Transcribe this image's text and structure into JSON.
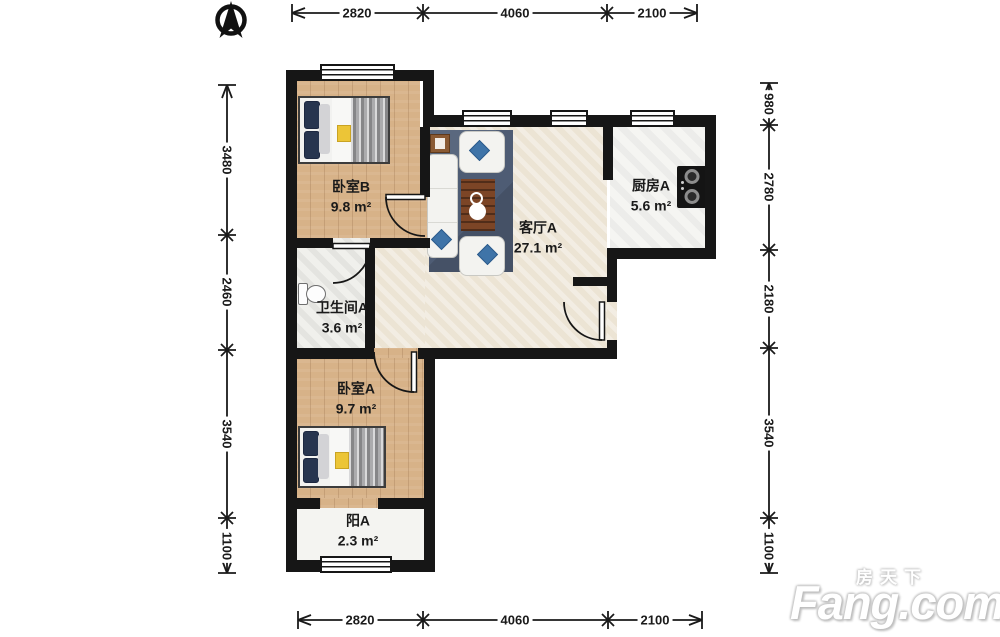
{
  "dimensions": {
    "top": [
      "2820",
      "4060",
      "2100"
    ],
    "bottom": [
      "2820",
      "4060",
      "2100"
    ],
    "left": [
      "3480",
      "2460",
      "3540",
      "1100"
    ],
    "right": [
      "980",
      "2780",
      "2180",
      "3540",
      "1100"
    ]
  },
  "rooms": [
    {
      "id": "bedroom-b",
      "name": "卧室B",
      "area": "9.8 m²"
    },
    {
      "id": "living-a",
      "name": "客厅A",
      "area": "27.1 m²"
    },
    {
      "id": "kitchen-a",
      "name": "厨房A",
      "area": "5.6 m²"
    },
    {
      "id": "bath-a",
      "name": "卫生间A",
      "area": "3.6 m²"
    },
    {
      "id": "bedroom-a",
      "name": "卧室A",
      "area": "9.7 m²"
    },
    {
      "id": "balcony-a",
      "name": "阳A",
      "area": "2.3 m²"
    }
  ],
  "icons": {
    "north_arrow": "compass-north-arrow"
  },
  "watermark": {
    "cn": "房天下",
    "en": "Fang.com"
  },
  "colors": {
    "wall": "#161616",
    "wood_floor": "#d7b288",
    "living_tile": "#ece4d4",
    "kitchen_tile": "#f5f5f2",
    "rug": "#4e5c74",
    "pillow_accent": "#3f74a8",
    "table_wood": "#7c4526",
    "stove": "#141414"
  }
}
